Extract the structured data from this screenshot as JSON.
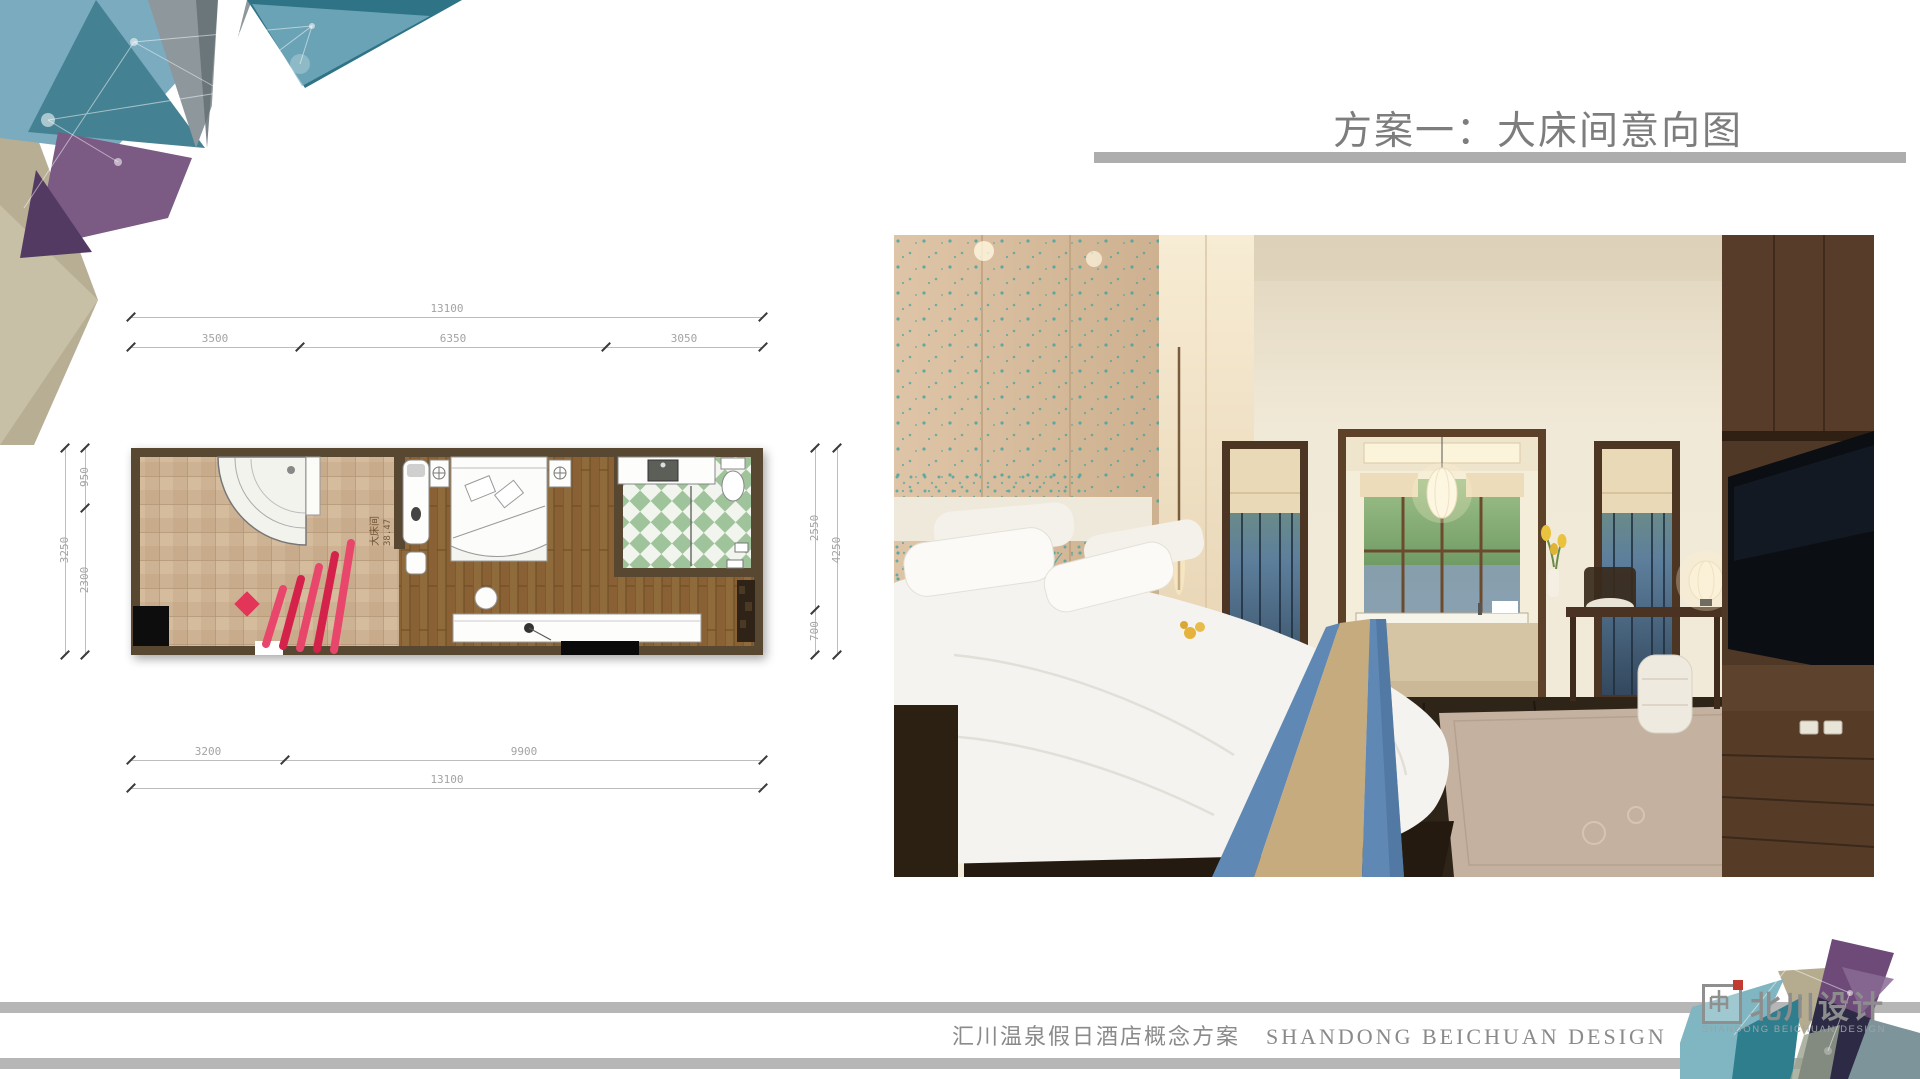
{
  "slide": {
    "title": "方案一：大床间意向图",
    "footer": {
      "cn": "汇川温泉假日酒店概念方案",
      "en": "SHANDONG BEICHUAN DESIGN"
    },
    "logo": {
      "name": "北川设计",
      "sub": "SHANDONG BEICHUAN DESIGN"
    }
  },
  "floorplan": {
    "label": {
      "room": "大床间",
      "area": "38.47"
    },
    "dims": {
      "top_total": "13100",
      "top_segments": [
        "3500",
        "6350",
        "3050"
      ],
      "bottom_segments": [
        "3200",
        "9900"
      ],
      "bottom_total": "13100",
      "left_segments": [
        "950",
        "2300"
      ],
      "left_total": "3250",
      "right_segments": [
        "2550",
        "700"
      ],
      "right_total": "4250"
    }
  },
  "colors": {
    "title_gray": "#7d7d7d",
    "bar_gray": "#adadad",
    "deco_teal": "#2f7386",
    "deco_light_blue": "#7aabbe",
    "deco_purple": "#7b5a84",
    "deco_khaki": "#b7ae94",
    "plan_wall_brown": "#584832",
    "plan_red_accent": "#e03a5e",
    "bath_tile_green": "#9fc39a",
    "runner_blue": "#5f88b4",
    "runner_tan": "#c6ab7e",
    "logo_red": "#c23b30"
  }
}
